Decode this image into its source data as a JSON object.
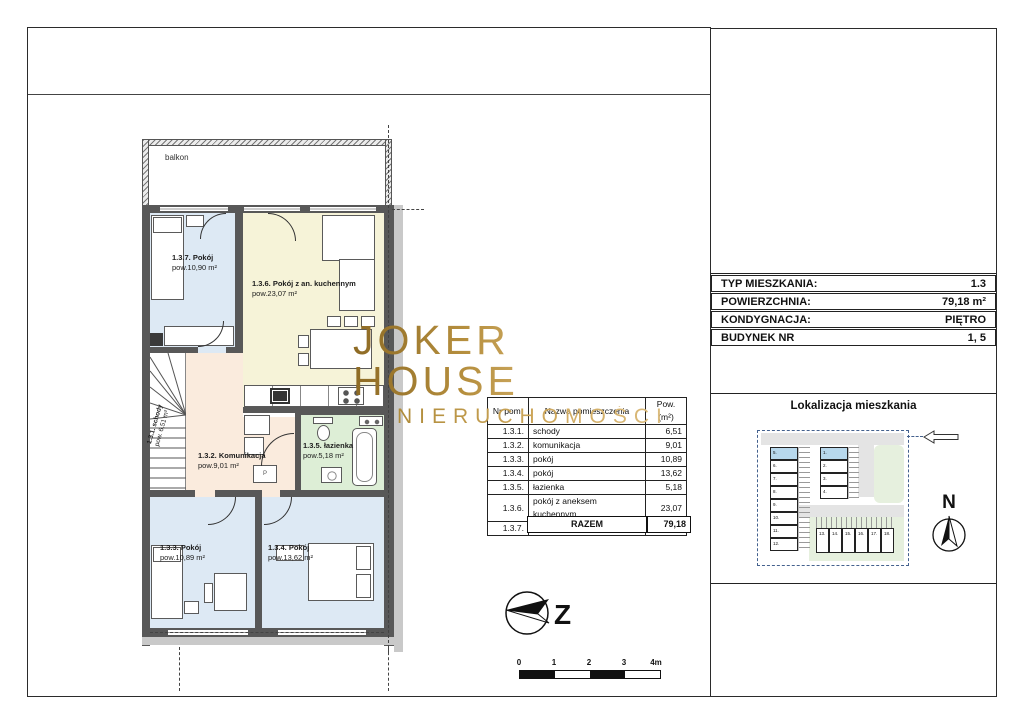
{
  "logo": {
    "line1": "JOKER HOUSE",
    "line2": "NIERUCHOMOŚCI"
  },
  "info_table": {
    "rows": [
      {
        "label": "TYP MIESZKANIA:",
        "value": "1.3"
      },
      {
        "label": "POWIERZCHNIA:",
        "value": "79,18 m²"
      },
      {
        "label": "KONDYGNACJA:",
        "value": "PIĘTRO"
      },
      {
        "label": "BUDYNEK NR",
        "value": "1, 5"
      }
    ]
  },
  "room_table": {
    "headers": [
      "Nr pom.",
      "Nazwa pomieszczenia",
      "Pow. (m²)"
    ],
    "rows": [
      [
        "1.3.1.",
        "schody",
        "6,51"
      ],
      [
        "1.3.2.",
        "komunikacja",
        "9,01"
      ],
      [
        "1.3.3.",
        "pokój",
        "10,89"
      ],
      [
        "1.3.4.",
        "pokój",
        "13,62"
      ],
      [
        "1.3.5.",
        "łazienka",
        "5,18"
      ],
      [
        "1.3.6.",
        "pokój z aneksem kuchennym",
        "23,07"
      ],
      [
        "1.3.7.",
        "pokój",
        "10,90"
      ]
    ],
    "total_label": "RAZEM",
    "total_value": "79,18"
  },
  "plan": {
    "balcony_label": "balkon",
    "washer_label": "P",
    "compass_letter": "Z",
    "rooms": [
      {
        "name": "1.3.7. Pokój",
        "area": "pow.10,90 m²"
      },
      {
        "name": "1.3.6. Pokój z an. kuchennym",
        "area": "pow.23,07 m²"
      },
      {
        "name": "1.3.1. schody",
        "area": "pow. 6,51 m²"
      },
      {
        "name": "1.3.2. Komunikacja",
        "area": "pow.9,01 m²"
      },
      {
        "name": "1.3.5. łazienka",
        "area": "pow.5,18 m²"
      },
      {
        "name": "1.3.3. Pokój",
        "area": "pow.10,89 m²"
      },
      {
        "name": "1.3.4. Pokój",
        "area": "pow.13,62 m²"
      }
    ]
  },
  "scale_bar": {
    "ticks": [
      "0",
      "1",
      "2",
      "3",
      "4m"
    ]
  },
  "location": {
    "title": "Lokalizacja mieszkania",
    "north_letter": "N",
    "left_column": [
      "5.",
      "6.",
      "7.",
      "8.",
      "9.",
      "10.",
      "11.",
      "12."
    ],
    "middle_column": [
      "1.",
      "2.",
      "3.",
      "4."
    ],
    "bottom_row": [
      "13.",
      "14.",
      "15.",
      "16.",
      "17.",
      "18."
    ],
    "highlighted_buildings": [
      "5.",
      "1."
    ]
  },
  "colors": {
    "logo_gold": "#b98f3e",
    "room_blue": "#dde9f4",
    "room_yellow": "#f6f3d8",
    "room_beige": "#faebdd",
    "room_green": "#ddeed6",
    "site_green": "#e6f0de",
    "site_road": "#e4e4e4",
    "highlight_blue": "#b8d8ec",
    "wall_gray": "#585858"
  }
}
